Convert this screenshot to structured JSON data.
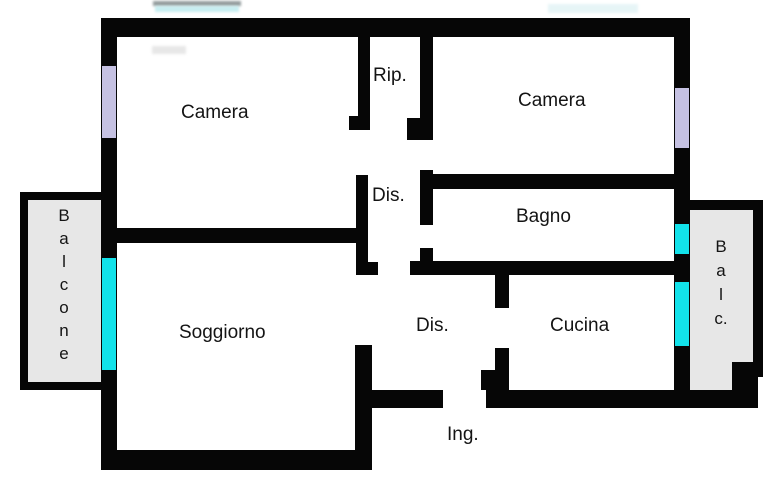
{
  "canvas": {
    "width": 778,
    "height": 500
  },
  "colors": {
    "wall": "#060606",
    "balcony": "#e7e7e7",
    "lavender": "#c5c1e2",
    "cyan": "#12e2ea",
    "text": "#141414",
    "background": "#ffffff"
  },
  "rooms": {
    "camera_left": {
      "label": "Camera"
    },
    "rip": {
      "label": "Rip."
    },
    "camera_right": {
      "label": "Camera"
    },
    "dis_upper": {
      "label": "Dis."
    },
    "bagno": {
      "label": "Bagno"
    },
    "soggiorno": {
      "label": "Soggiorno"
    },
    "dis_lower": {
      "label": "Dis."
    },
    "cucina": {
      "label": "Cucina"
    },
    "ingresso": {
      "label": "Ing."
    }
  },
  "balconies": {
    "left": {
      "label": "Balcone",
      "label_stacked": "B\na\nl\nc\no\nn\ne"
    },
    "right": {
      "label": "Balc.",
      "label_stacked": "B\na\nl\nc."
    }
  }
}
